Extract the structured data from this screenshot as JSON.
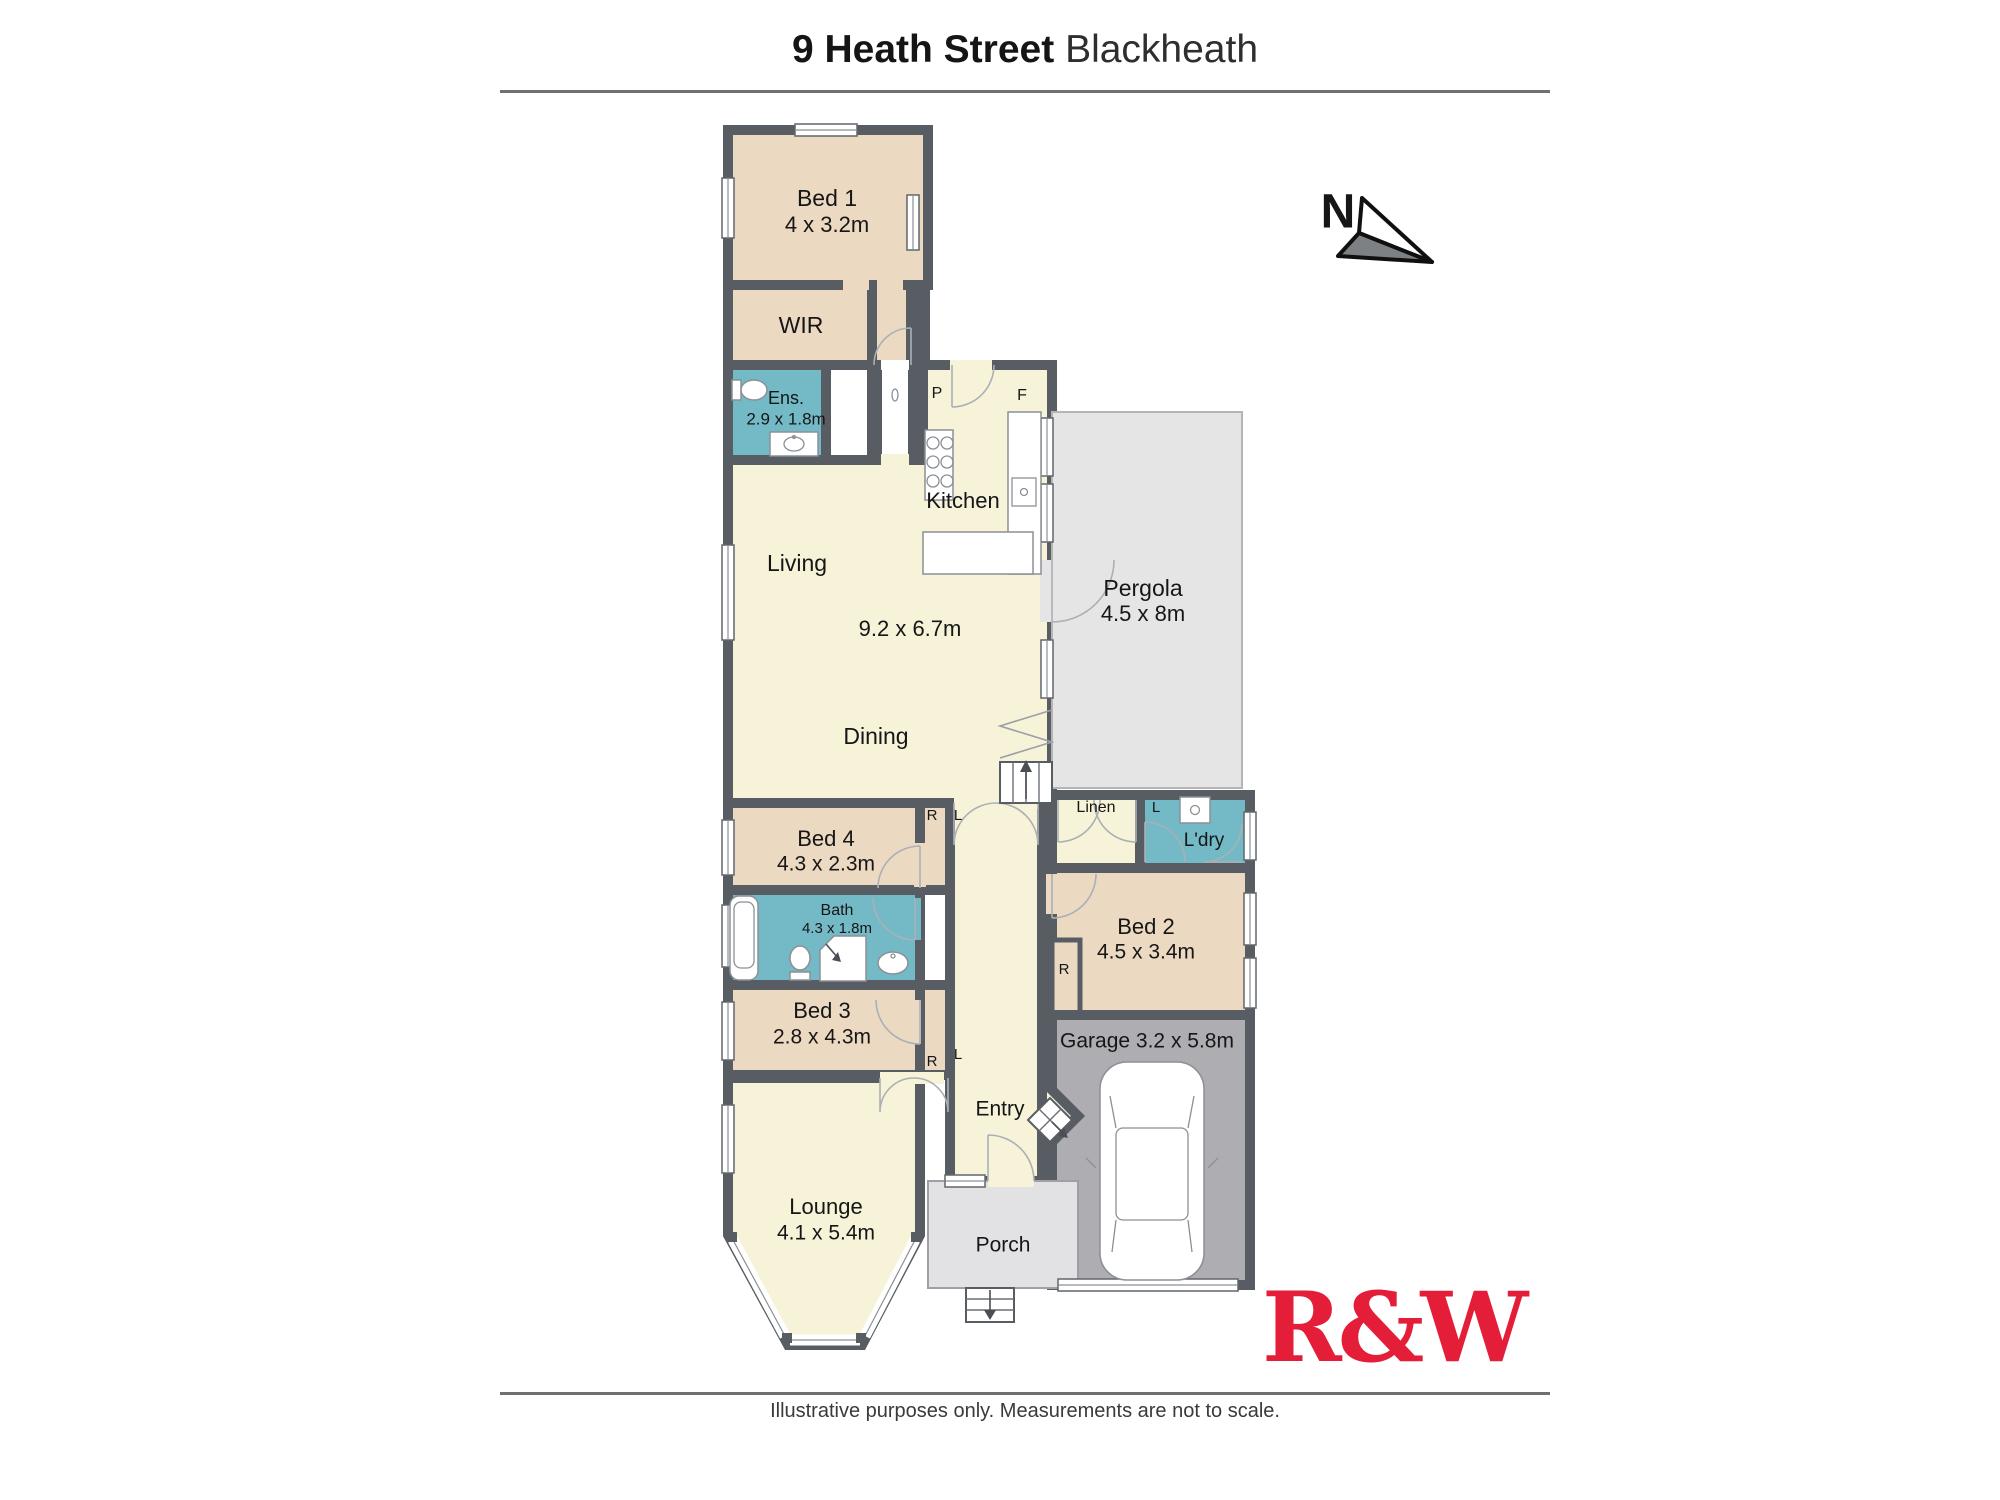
{
  "header": {
    "title_bold": "9 Heath Street",
    "title_light": "Blackheath"
  },
  "compass": {
    "north_label": "N"
  },
  "rooms": {
    "bed1": {
      "name": "Bed 1",
      "dims": "4 x 3.2m"
    },
    "wir": {
      "name": "WIR"
    },
    "ens": {
      "name": "Ens.",
      "dims": "2.9 x 1.8m"
    },
    "kitchen": {
      "name": "Kitchen"
    },
    "living": {
      "name": "Living",
      "dims": "9.2 x 6.7m"
    },
    "dining": {
      "name": "Dining"
    },
    "pergola": {
      "name": "Pergola",
      "dims": "4.5 x 8m"
    },
    "bed4": {
      "name": "Bed 4",
      "dims": "4.3 x 2.3m"
    },
    "linen": {
      "name": "Linen"
    },
    "laundry": {
      "name": "L'dry"
    },
    "bed2": {
      "name": "Bed 2",
      "dims": "4.5 x 3.4m"
    },
    "bath": {
      "name": "Bath",
      "dims": "4.3 x 1.8m"
    },
    "bed3": {
      "name": "Bed 3",
      "dims": "2.8 x 4.3m"
    },
    "garage": {
      "name": "Garage 3.2 x 5.8m"
    },
    "entry": {
      "name": "Entry"
    },
    "lounge": {
      "name": "Lounge",
      "dims": "4.1 x 5.4m"
    },
    "porch": {
      "name": "Porch"
    }
  },
  "markers": {
    "pantry": "P",
    "fridge": "F",
    "robe": "R",
    "linen_cupboard": "L"
  },
  "logo": {
    "brand": "R&W"
  },
  "footer": {
    "disclaimer": "Illustrative purposes only. Measurements are not to scale."
  },
  "colors": {
    "bedroom": "#ecd9c2",
    "living_area": "#f6f3d8",
    "wet_area": "#74bac6",
    "pergola": "#e5e5e5",
    "garage": "#aeaeb2",
    "porch": "#e2e2e5",
    "wall": "#585d63",
    "brand_red": "#e41e39"
  }
}
